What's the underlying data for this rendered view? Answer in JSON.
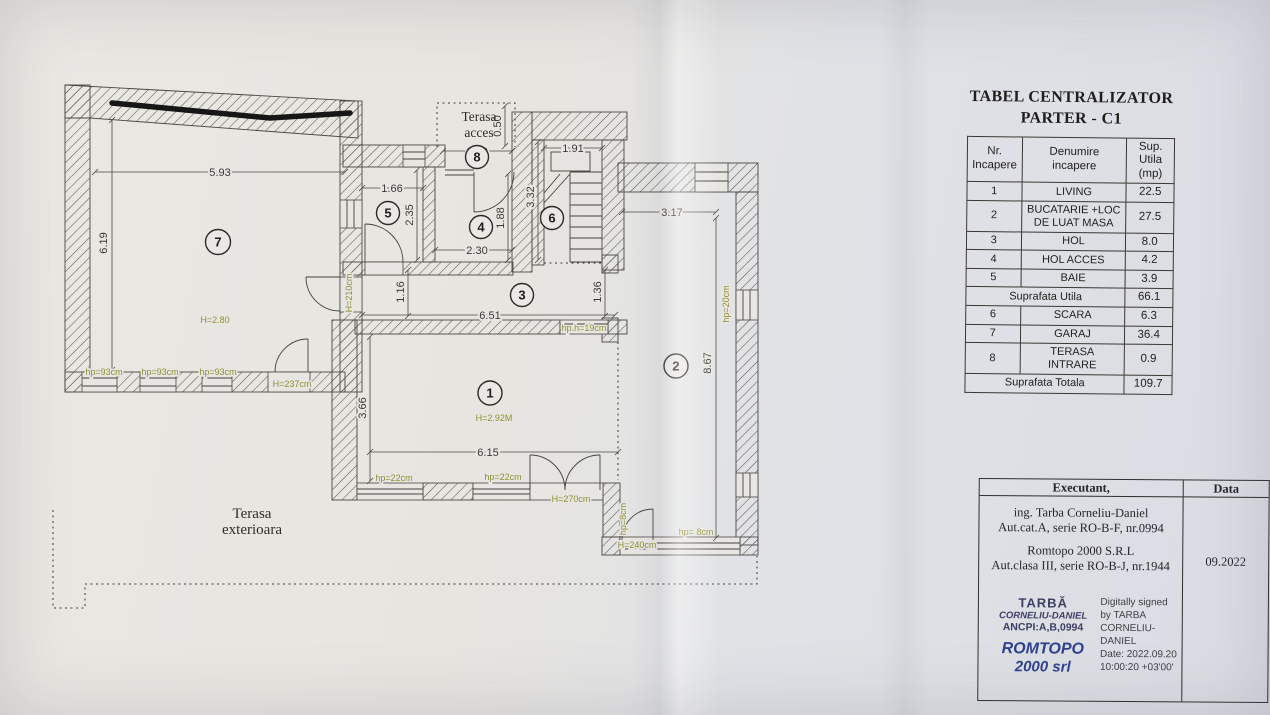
{
  "colors": {
    "paper": "#e8e6e2",
    "line": "#3f3d3a",
    "olive": "#8f8f33",
    "stamp_navy": "#3d3f63",
    "stamp_blue": "#31418f"
  },
  "plan": {
    "dims": {
      "w593": "5.93",
      "h619": "6.19",
      "w166": "1.66",
      "h235": "2.35",
      "w170": "1.70",
      "h050": "0.50",
      "w191": "1.91",
      "h332": "3.32",
      "w230": "2.30",
      "h188": "1.88",
      "h116": "1.16",
      "w651": "6.51",
      "h136": "1.36",
      "h366": "3.66",
      "w615": "6.15",
      "w317": "3.17",
      "h867": "8.67"
    },
    "green": {
      "h280": "H=2.80",
      "h292": "H=2.92M",
      "h237": "H=237cm",
      "h210": "H=210cm",
      "h270": "H=270cm",
      "h240": "H=240cm",
      "hp93": "hp=93cm",
      "hp22": "hp=22cm",
      "hp20": "hp=20cm",
      "hp8": "hp= 8cm",
      "hp8v": "hp=8cm",
      "hp19": "hp h=19cm"
    },
    "areas": {
      "acces1": "Terasa",
      "acces2": "acces",
      "ext1": "Terasa",
      "ext2": "exterioara"
    },
    "rooms": {
      "r1": "1",
      "r2": "2",
      "r3": "3",
      "r4": "4",
      "r5": "5",
      "r6": "6",
      "r7": "7",
      "r8": "8"
    }
  },
  "table": {
    "title_l1": "TABEL CENTRALIZATOR",
    "title_l2": "PARTER - C1",
    "col_nr": "Nr.\nIncapere",
    "col_den": "Denumire\nincapere",
    "col_sup": "Sup.\nUtila\n(mp)",
    "rows": [
      {
        "nr": "1",
        "den": "LIVING",
        "sup": "22.5"
      },
      {
        "nr": "2",
        "den": "BUCATARIE +LOC\nDE LUAT MASA",
        "sup": "27.5"
      },
      {
        "nr": "3",
        "den": "HOL",
        "sup": "8.0"
      },
      {
        "nr": "4",
        "den": "HOL ACCES",
        "sup": "4.2"
      },
      {
        "nr": "5",
        "den": "BAIE",
        "sup": "3.9"
      }
    ],
    "subtotal_label": "Suprafata Utila",
    "subtotal_value": "66.1",
    "rows2": [
      {
        "nr": "6",
        "den": "SCARA",
        "sup": "6.3"
      },
      {
        "nr": "7",
        "den": "GARAJ",
        "sup": "36.4"
      },
      {
        "nr": "8",
        "den": "TERASA\nINTRARE",
        "sup": "0.9"
      }
    ],
    "total_label": "Suprafata Totala",
    "total_value": "109.7"
  },
  "signature": {
    "executant_label": "Executant,",
    "data_label": "Data",
    "line1": "ing. Tarba Corneliu-Daniel",
    "line2": "Aut.cat.A, serie RO-B-F, nr.0994",
    "line3": "Romtopo 2000 S.R.L",
    "line4": "Aut.clasa III, serie RO-B-J, nr.1944",
    "date": "09.2022",
    "stamp_l1": "TARBĂ",
    "stamp_l2": "CORNELIU-DANIEL",
    "stamp_l3": "ANCPI:A,B,0994",
    "stamp_l4": "ROMTOPO",
    "stamp_l5": "2000 srl",
    "digital_l1": "Digitally signed",
    "digital_l2": "by TARBA",
    "digital_l3": "CORNELIU-",
    "digital_l4": "DANIEL",
    "digital_l5": "Date: 2022.09.20",
    "digital_l6": "10:00:20 +03'00'"
  }
}
